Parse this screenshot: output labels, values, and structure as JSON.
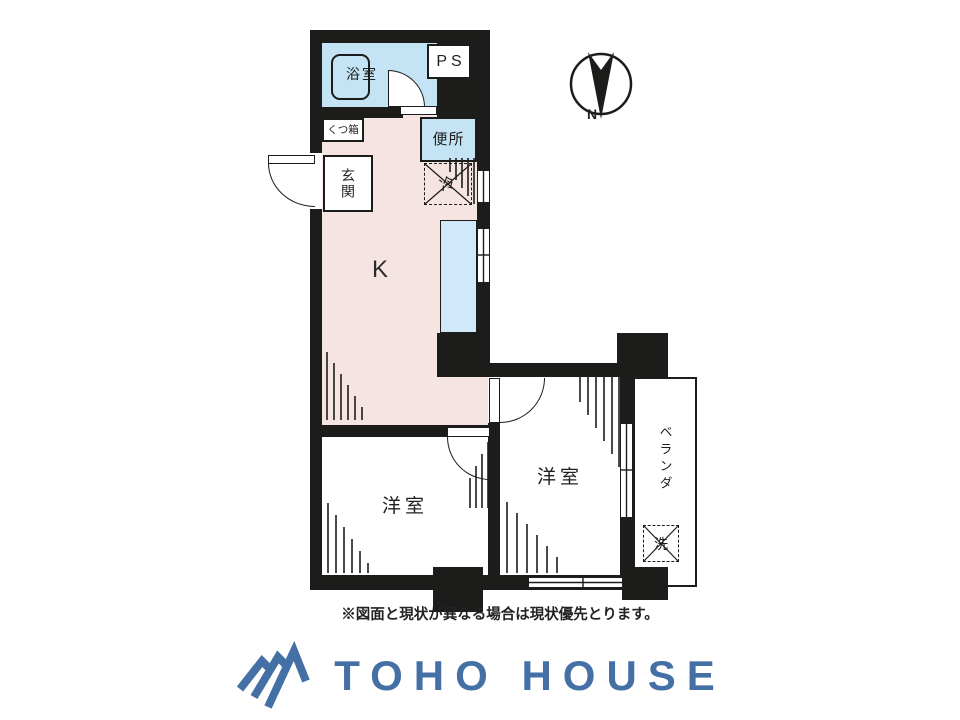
{
  "floorplan": {
    "labels": {
      "bathroom": "浴室",
      "pipe_space": "PS",
      "shoe_box": "くつ箱",
      "entrance": "玄関",
      "toilet": "便所",
      "refrigerator": "冷",
      "kitchen": "K",
      "western_room_1": "洋室",
      "western_room_2": "洋室",
      "veranda": "ベランダ",
      "washing_machine": "洗"
    },
    "compass": {
      "north_label": "N"
    },
    "note": "※図面と現状が異なる場合は現状優先とります。"
  },
  "footer": {
    "brand_name": "TOHO HOUSE"
  },
  "colors": {
    "wall": "#1c1c1a",
    "kitchen_floor": "#f6e4e2",
    "wet_area": "#c4e3f5",
    "counter": "#cfe9fa",
    "brand_blue": "#4570a5"
  }
}
